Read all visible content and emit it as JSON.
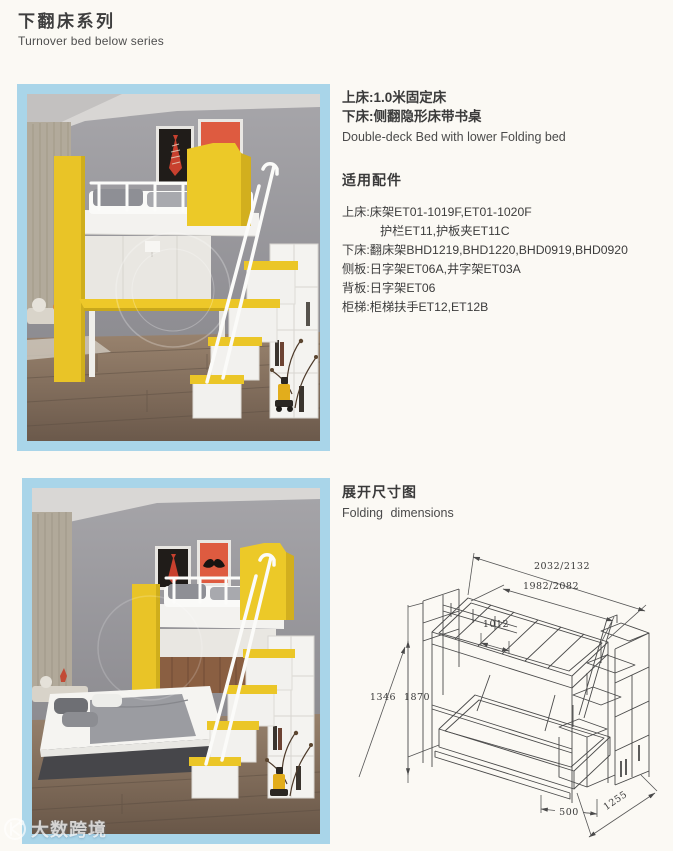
{
  "header": {
    "title_cn": "下翻床系列",
    "title_en": "Turnover bed below series"
  },
  "product": {
    "upper_bed": "上床:1.0米固定床",
    "lower_bed": "下床:侧翻隐形床带书桌",
    "name_en": "Double-deck Bed with lower Folding bed"
  },
  "accessories": {
    "heading": "适用配件",
    "lines": [
      {
        "text": "上床:床架ET01-1019F,ET01-1020F",
        "indent": false
      },
      {
        "text": "护栏ET11,护板夹ET11C",
        "indent": true
      },
      {
        "text": "下床:翻床架BHD1219,BHD1220,BHD0919,BHD0920",
        "indent": false
      },
      {
        "text": "侧板:日字架ET06A,井字架ET03A",
        "indent": false
      },
      {
        "text": "背板:日字架ET06",
        "indent": false
      },
      {
        "text": "柜梯:柜梯扶手ET12,ET12B",
        "indent": false
      }
    ]
  },
  "folding": {
    "heading_cn": "展开尺寸图",
    "heading_en": "Folding  dimensions",
    "dims": {
      "overall_top": "2032/2132",
      "overall_inner": "1982/2082",
      "width_inner": "1012",
      "height_left_a": "1346",
      "height_left_b": "1870",
      "depth_right": "1255",
      "stair_width": "500"
    }
  },
  "watermark": {
    "brand": "大数跨境"
  },
  "colors": {
    "frame_blue": "#a9d5e9",
    "accent_yellow": "#e9c427",
    "poster_red": "#de5b40",
    "wall_gray": "#98979b",
    "line_color": "#4a4a4a"
  }
}
